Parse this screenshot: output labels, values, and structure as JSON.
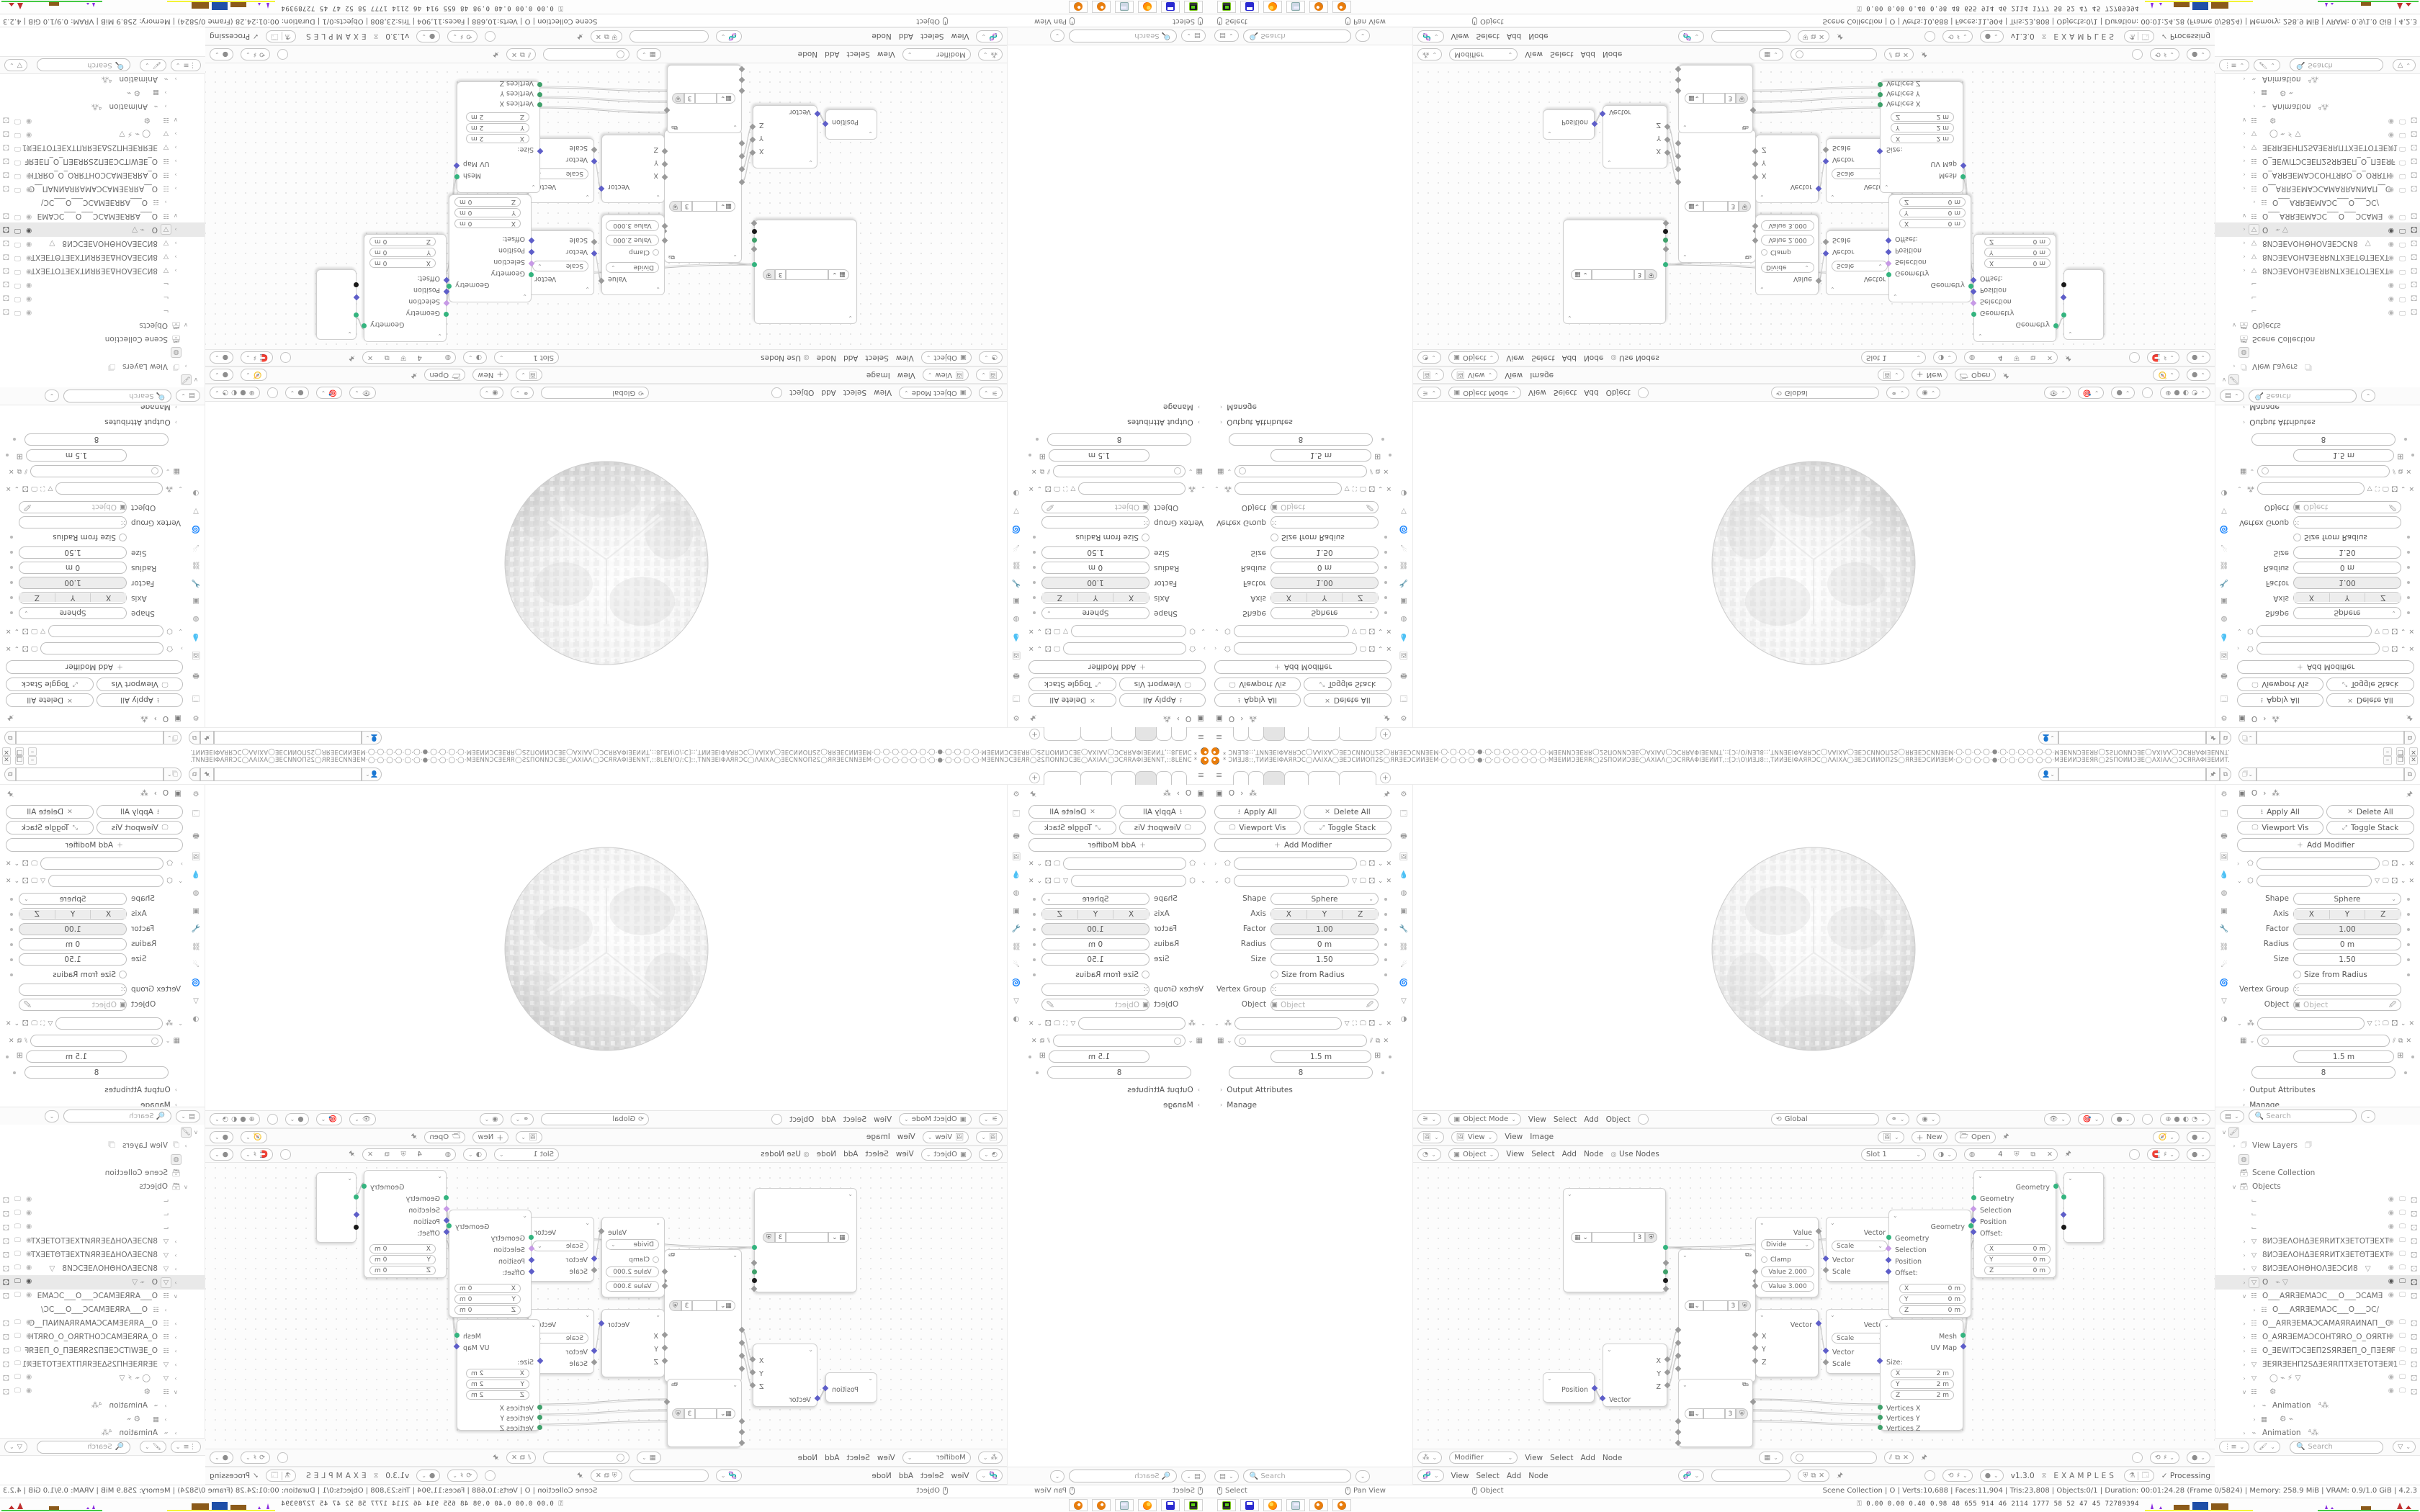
{
  "window": {
    "title": "* ƆИƎ⅃8::,TИИƎEIΦAЯRƆC◯ΛAIXA◯ƎEƆCИИOП2S◯ЯRƎEƆCИИƎEM·◯·◯·◯·◯·●·◯·◯·◯·◯·◯·◯·◯·MƎEИИƆƎEЯR◯2SПOИИƆƎE◯AXIAΛ◯ƆCЯRAΦIƎEИИT,::[Ɔ:\\O\\ИƎ⅃8::,TИИƎEIΦAЯRƆC◯ΛAIXA◯ƎEƆCИИOП2S◯ЯRƎEƆCИИƎEM·◯·◯·◯·◯·●·◯·◯·◯·◯·◯·◯·MƎEИИƆƎEЯR◯2SПOИИƆƎE◯AXIAΛ◯ƆCЯRAΦIƎEИИT.",
    "buttons": [
      "–",
      "❐",
      "✕"
    ],
    "workspace_tabs": {
      "labels": [
        "",
        "",
        "",
        "",
        "",
        ""
      ],
      "active_index": 2,
      "add_label": "+"
    }
  },
  "topbar": {
    "scene_picker_value": "",
    "viewlayer_picker_value": ""
  },
  "properties": {
    "breadcrumb": [
      "▣",
      "O",
      "›",
      "⁂"
    ],
    "toolbar": {
      "apply_all": "Apply All",
      "delete_all": "Delete All",
      "viewport_vis": "Viewport Vis",
      "toggle_stack": "Toggle Stack",
      "add_modifier": "Add Modifier"
    },
    "modifier": {
      "shape_label": "Shape",
      "shape_value": "Sphere",
      "axis_label": "Axis",
      "axis_values": [
        "X",
        "Y",
        "Z"
      ],
      "factor_label": "Factor",
      "factor_value": "1.00",
      "radius_label": "Radius",
      "radius_value": "0 m",
      "size_label": "Size",
      "size_value": "1.50",
      "size_from_radius_label": "Size from Radius",
      "vertex_group_label": "Vertex Group",
      "object_label": "Object",
      "object_placeholder": "Object"
    },
    "modifier2": {
      "length_value": "1.5 m",
      "count_value": "8",
      "output_attributes_label": "Output Attributes",
      "manage_label": "Manage"
    },
    "search_placeholder": "Search"
  },
  "viewport_header": {
    "mode_value": "Object Mode",
    "menus": [
      "View",
      "Select",
      "Add",
      "Object"
    ],
    "orientation_value": "Global"
  },
  "image_header": {
    "view_value": "View",
    "menus": [
      "View",
      "Image"
    ],
    "new_label": "New",
    "open_label": "Open"
  },
  "shader_header": {
    "object_value": "Object",
    "menus": [
      "View",
      "Select",
      "Add",
      "Node"
    ],
    "use_nodes_label": "Use Nodes",
    "slot_value": "Slot 1",
    "material_count": "4"
  },
  "node_header_a": {
    "tree_value": "Modifier",
    "menus": [
      "View",
      "Select",
      "Add",
      "Node"
    ]
  },
  "node_header_b": {
    "menus": [
      "View",
      "Select",
      "Add",
      "Node"
    ],
    "version": "v1.3.0",
    "brand": "EXAMPLES",
    "status": "Processing",
    "check": "✓"
  },
  "outliner": {
    "search_placeholder": "Search",
    "rows": [
      {
        "depth": 0,
        "expand": "v",
        "icon": "🖌",
        "boxed": true,
        "label": "",
        "trail": "",
        "toggles": false,
        "selected": false
      },
      {
        "depth": 1,
        "expand": "›",
        "icon": "🗇",
        "boxed": false,
        "label": "View Layers",
        "trail": "🗇",
        "toggles": false,
        "selected": false
      },
      {
        "depth": 1,
        "expand": "",
        "icon": "◍",
        "boxed": true,
        "label": "",
        "trail": "",
        "toggles": false,
        "selected": false
      },
      {
        "depth": 1,
        "expand": "",
        "icon": "🗃",
        "boxed": false,
        "label": "Scene Collection",
        "trail": "",
        "toggles": false,
        "selected": false
      },
      {
        "depth": 1,
        "expand": "v",
        "icon": "🗃",
        "boxed": false,
        "label": "Objects",
        "trail": "",
        "toggles": false,
        "selected": false
      },
      {
        "depth": 2,
        "expand": "",
        "icon": "⌙",
        "boxed": false,
        "label": "",
        "trail": "",
        "toggles": true,
        "selected": false
      },
      {
        "depth": 2,
        "expand": "",
        "icon": "⌙",
        "boxed": false,
        "label": "",
        "trail": "",
        "toggles": true,
        "selected": false
      },
      {
        "depth": 2,
        "expand": "",
        "icon": "⌙",
        "boxed": false,
        "label": "",
        "trail": "",
        "toggles": true,
        "selected": false
      },
      {
        "depth": 2,
        "expand": "›",
        "icon": "▽",
        "boxed": false,
        "label": "8ИƆƎEΛOHΔƎEЯRИTXƎETOTƎEXT",
        "trail": "",
        "toggles": true,
        "selected": false
      },
      {
        "depth": 2,
        "expand": "›",
        "icon": "▽",
        "boxed": false,
        "label": "8ИƆƎEΛOHΔƎEЯRИTXƎETΘTƎEXT",
        "trail": "",
        "toggles": true,
        "selected": false
      },
      {
        "depth": 2,
        "expand": "›",
        "icon": "▽",
        "boxed": false,
        "label": "8ИƆƎEΛOHΘHOΛƎEƆCИ8",
        "trail": "▽",
        "toggles": true,
        "selected": false
      },
      {
        "depth": 2,
        "expand": "›",
        "icon": "▽",
        "boxed": true,
        "label": "O",
        "trail": "⌁ ▽",
        "toggles": true,
        "selected": true
      },
      {
        "depth": 2,
        "expand": "v",
        "icon": "☷",
        "boxed": false,
        "label": "O___AЯRƎEMAƆC___O___ƆCAMƎ",
        "trail": "",
        "toggles": true,
        "selected": false
      },
      {
        "depth": 3,
        "expand": "›",
        "icon": "☷",
        "boxed": false,
        "label": "O___AЯRƎEMAƆC___O___ƆC∕",
        "trail": "",
        "toggles": false,
        "selected": false
      },
      {
        "depth": 2,
        "expand": "›",
        "icon": "☷",
        "boxed": false,
        "label": "O__AЯRƎEMAƆCAMAЯRAИNAП__C",
        "trail": "",
        "toggles": true,
        "selected": false
      },
      {
        "depth": 2,
        "expand": "›",
        "icon": "☷",
        "boxed": false,
        "label": "O_AЯRƎEMAƆCOHTЯRO_O_OЯRTH",
        "trail": "",
        "toggles": true,
        "selected": false
      },
      {
        "depth": 2,
        "expand": "›",
        "icon": "☷",
        "boxed": false,
        "label": "O_ƎEWITƆCƎEП2SЯRƎEП_O_ПƎEЯF",
        "trail": "",
        "toggles": true,
        "selected": false
      },
      {
        "depth": 2,
        "expand": "›",
        "icon": "▽",
        "boxed": false,
        "label": "ƎEЯRƎEHП2SΔƎEЯRПTXƎETOTƎEX1",
        "trail": "",
        "toggles": true,
        "selected": false
      },
      {
        "depth": 2,
        "expand": "›",
        "icon": "▽",
        "boxed": false,
        "label": "",
        "trail": "◯  ⌁ ⚡ ▽",
        "toggles": true,
        "selected": false
      },
      {
        "depth": 2,
        "expand": "v",
        "icon": "☷",
        "boxed": false,
        "label": "",
        "trail": "⚙",
        "toggles": true,
        "selected": false
      },
      {
        "depth": 3,
        "expand": "›",
        "icon": "⌁",
        "boxed": false,
        "label": "Animation",
        "trail": "⁴⁂",
        "toggles": false,
        "selected": false
      },
      {
        "depth": 3,
        "expand": "›",
        "icon": "▦",
        "boxed": false,
        "label": "",
        "trail": "⚙  ⌁",
        "toggles": false,
        "selected": false
      },
      {
        "depth": 2,
        "expand": "›",
        "icon": "⌁",
        "boxed": false,
        "label": "Animation",
        "trail": "⁴⁂",
        "toggles": false,
        "selected": false
      }
    ]
  },
  "nodes": {
    "zone_count_value": "3",
    "position_out": "Position",
    "separate_outs": [
      "X",
      "Y",
      "Z"
    ],
    "vector_in": "Vector",
    "math_op": "Divide",
    "math_clamp": "Clamp",
    "math_value1": "Value   2.000",
    "math_value2": "Value   3.000",
    "math_out": "Value",
    "vecmath_op": "Scale",
    "vecmath_out": "Vector",
    "vecmath_ins": [
      "Vector",
      "Scale"
    ],
    "combine_out": "Vector",
    "combine_ins": [
      "X",
      "Y",
      "Z"
    ],
    "cube_outs": [
      "Mesh",
      "UV Map"
    ],
    "cube_size_label": "Size:",
    "cube_size_fields": [
      [
        "X",
        "2 m"
      ],
      [
        "Y",
        "2 m"
      ],
      [
        "Z",
        "2 m"
      ]
    ],
    "cube_ins": [
      "Vertices X",
      "Vertices Y",
      "Vertices Z"
    ],
    "setpos_out": "Geometry",
    "setpos_ins": [
      "Geometry",
      "Selection",
      "Position",
      "Offset:"
    ],
    "setpos_fields": [
      [
        "X",
        "0 m"
      ],
      [
        "Y",
        "0 m"
      ],
      [
        "Z",
        "0 m"
      ]
    ]
  },
  "statusbar": {
    "hints": [
      "Select",
      "Pan View",
      "Object"
    ],
    "stats": "Scene Collection | O | Verts:10,688 | Faces:11,904 | Tris:23,808 | Objects:0/1 | Duration: 00:01:24.28 (Frame 0/5824) | Memory: 258.9 MiB | VRAM: 0.9/1.0 GiB | 4.2.3"
  },
  "taskbar": {
    "apps": [
      "drive-app",
      "floppy64-app",
      "firefox",
      "calculator",
      "blender",
      "blender"
    ],
    "tray_text": "0.00 0.00 0.40 0.98   48   655  914   46   2114 1777   58    52    47    45  72789394"
  },
  "colors": {
    "accent_orange": "#e87d0d",
    "socket_geometry": "#34b47f",
    "socket_vector": "#5e5ec9",
    "socket_field": "#c79ae6",
    "socket_int": "#3fa06a",
    "socket_black": "#1a1a1a",
    "tab_active": "#e4e4e4"
  }
}
